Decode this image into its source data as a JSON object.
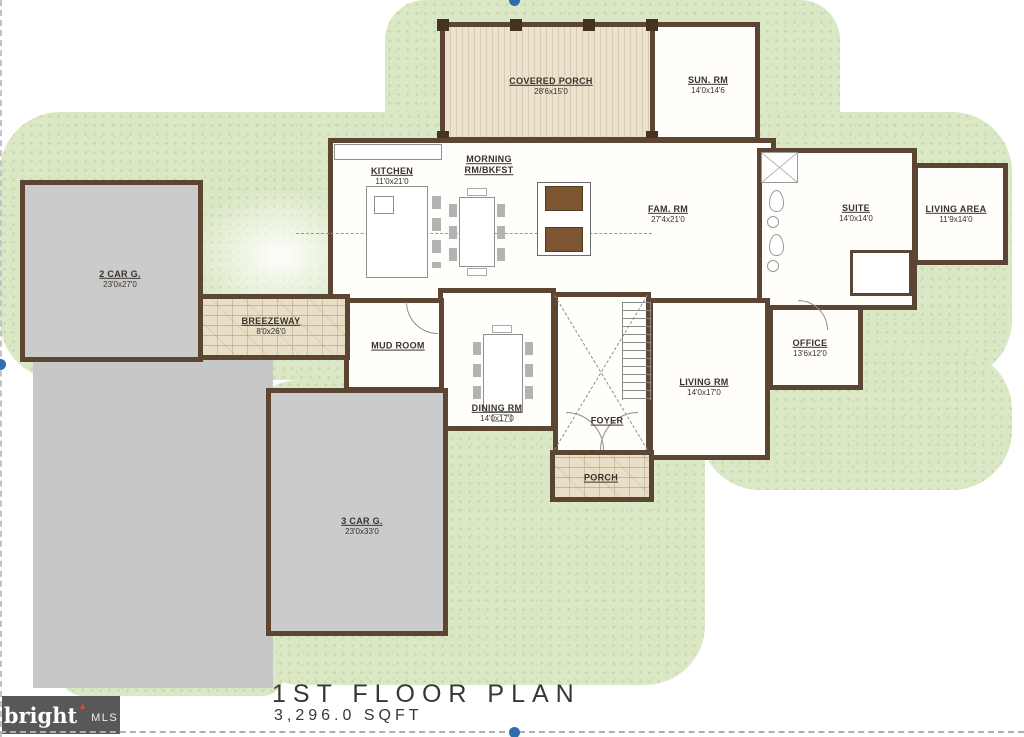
{
  "page": {
    "title": "1ST FLOOR PLAN",
    "sqft": "3,296.0 SQFT"
  },
  "logo": {
    "brand": "bright",
    "arrow": "▲",
    "suffix": "MLS"
  },
  "rooms": {
    "covered_porch": {
      "name": "COVERED PORCH",
      "dims": "28'6x15'0"
    },
    "sun_rm": {
      "name": "SUN. RM",
      "dims": "14'0x14'6"
    },
    "kitchen": {
      "name": "KITCHEN",
      "dims": "11'0x21'0"
    },
    "morning_rm": {
      "name": "MORNING RM/BKFST",
      "dims": ""
    },
    "fam_rm": {
      "name": "FAM. RM",
      "dims": "27'4x21'0"
    },
    "suite": {
      "name": "SUITE",
      "dims": "14'0x14'0"
    },
    "living_area": {
      "name": "LIVING AREA",
      "dims": "11'9x14'0"
    },
    "office": {
      "name": "OFFICE",
      "dims": "13'6x12'0"
    },
    "living_rm": {
      "name": "LIVING RM",
      "dims": "14'0x17'0"
    },
    "dining_rm": {
      "name": "DINING RM",
      "dims": "14'0x17'0"
    },
    "foyer": {
      "name": "FOYER",
      "dims": ""
    },
    "mud_room": {
      "name": "MUD ROOM",
      "dims": ""
    },
    "porch": {
      "name": "PORCH",
      "dims": ""
    },
    "breezeway": {
      "name": "BREEZEWAY",
      "dims": "8'0x26'0"
    },
    "garage2": {
      "name": "2 CAR G.",
      "dims": "23'0x27'0"
    },
    "garage3": {
      "name": "3 CAR G.",
      "dims": "23'0x33'0"
    }
  },
  "colors": {
    "wall": "#5c4533",
    "grass": "#dbe8c6",
    "pavement": "#c7c7c7",
    "porch_wood": "#e4dbc2",
    "stone": "#e7dfc6",
    "selection_handle": "#2e6db4",
    "logo_bg": "#58585a",
    "logo_accent": "#d94a38"
  }
}
